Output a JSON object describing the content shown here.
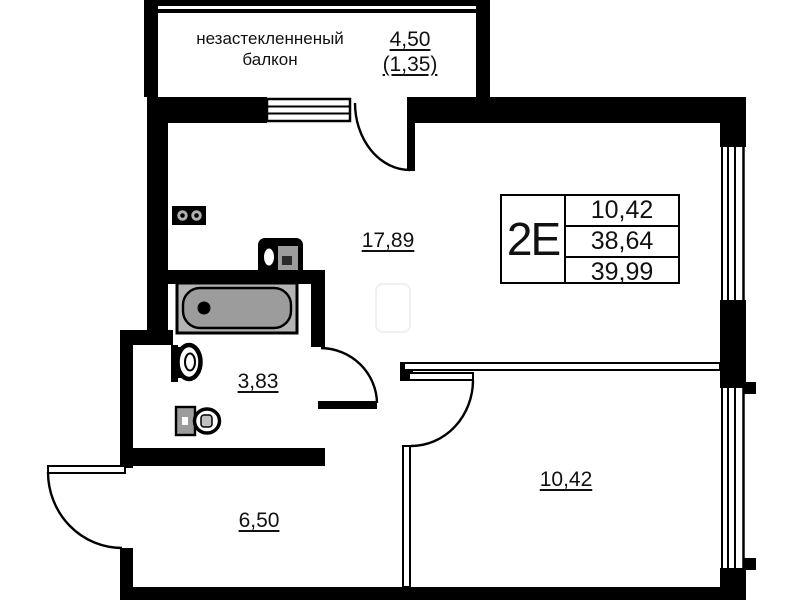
{
  "balcony": {
    "label_line1": "незастекленненый",
    "label_line2": "балкон",
    "area_total": "4,50",
    "area_reduced": "(1,35)"
  },
  "rooms": {
    "living_kitchen": {
      "area": "17,89"
    },
    "bathroom": {
      "area": "3,83"
    },
    "hallway": {
      "area": "6,50"
    },
    "bedroom": {
      "area": "10,42"
    }
  },
  "info_box": {
    "type_label": "2Е",
    "rows": [
      "10,42",
      "38,64",
      "39,99"
    ]
  },
  "fixtures": {
    "bathtub": "bathtub-icon",
    "sink": "sink-icon",
    "toilet": "toilet-icon",
    "washing_machine": "washing-machine-icon",
    "stove": "stove-icon"
  },
  "colors": {
    "line": "#000000",
    "fixture_fill": "#9c9c9c",
    "background": "#ffffff"
  }
}
